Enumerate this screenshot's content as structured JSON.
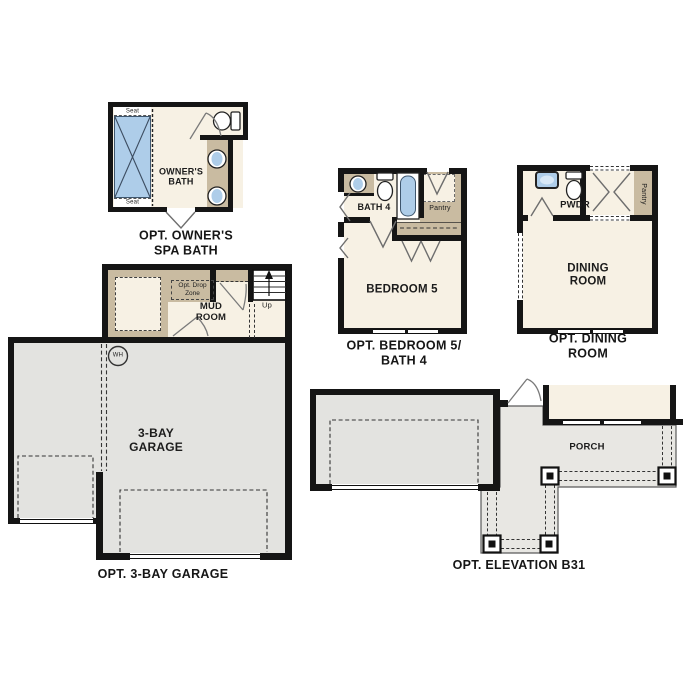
{
  "plans": {
    "spa_bath": {
      "caption": "OPT. OWNER'S\nSPA BATH",
      "labels": {
        "seat_top": "Seat",
        "seat_bottom": "Seat",
        "room": "OWNER'S\nBATH"
      }
    },
    "bedroom5": {
      "caption": "OPT. BEDROOM 5/\nBATH 4",
      "labels": {
        "bath": "BATH 4",
        "pantry": "Pantry",
        "room": "BEDROOM 5"
      }
    },
    "dining": {
      "caption": "OPT. DINING ROOM",
      "labels": {
        "powder": "PWDR",
        "pantry": "Pantry",
        "room": "DINING\nROOM"
      }
    },
    "garage": {
      "caption": "OPT. 3-BAY GARAGE",
      "labels": {
        "drop_zone": "Opt. Drop\nZone",
        "mud_room": "MUD\nROOM",
        "up": "Up",
        "water_heater": "WH",
        "room": "3-BAY\nGARAGE"
      }
    },
    "elevation": {
      "caption": "OPT. ELEVATION B31",
      "labels": {
        "porch": "PORCH"
      }
    }
  },
  "colors": {
    "wall": "#151515",
    "cream": "#f7f1e4",
    "tan": "#c9bba1",
    "blue": "#aecde9",
    "gray": "#e3e3e0",
    "porch": "#e8e7e3"
  }
}
